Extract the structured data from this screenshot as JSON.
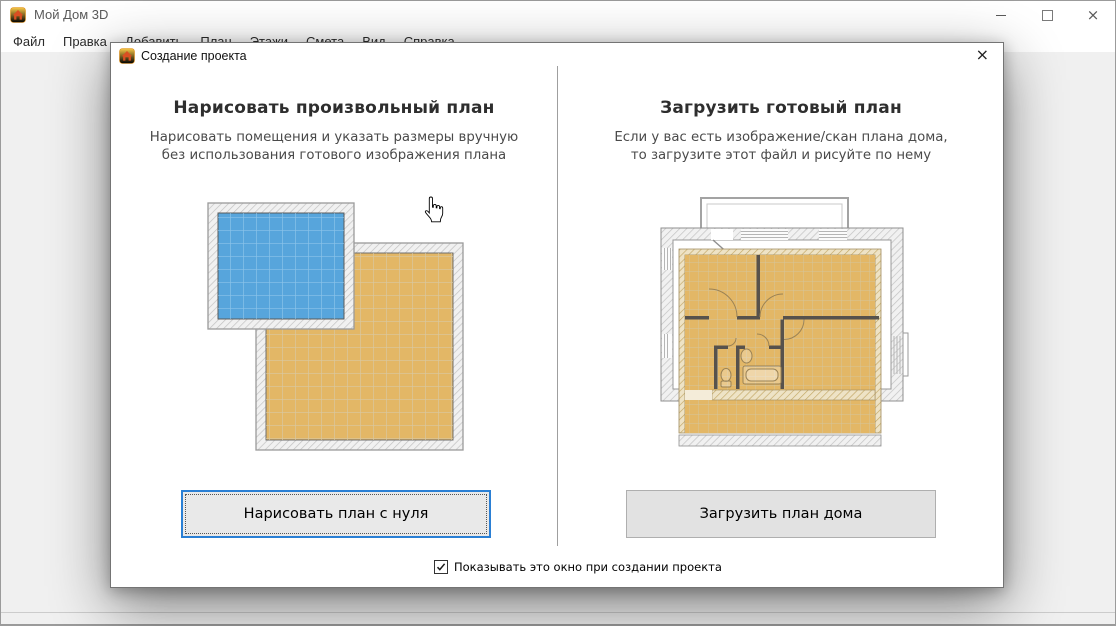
{
  "window": {
    "title": "Мой Дом 3D",
    "controls": {
      "minimize": "minimize",
      "maximize": "maximize",
      "close": "×"
    }
  },
  "menu": {
    "items": [
      "Файл",
      "Правка",
      "Добавить",
      "План",
      "Этажи",
      "Смета",
      "Вид",
      "Справка"
    ]
  },
  "dialog": {
    "title": "Создание проекта",
    "close": "×",
    "left_panel": {
      "heading": "Нарисовать произвольный план",
      "description_line1": "Нарисовать помещения и указать размеры вручную",
      "description_line2": "без использования готового изображения плана",
      "button_label": "Нарисовать план с нуля"
    },
    "right_panel": {
      "heading": "Загрузить готовый план",
      "description_line1": "Если у вас есть изображение/скан плана дома,",
      "description_line2": "то загрузите этот файл и рисуйте по нему",
      "button_label": "Загрузить план дома"
    },
    "footer_checkbox": {
      "label": "Показывать это окно при создании проекта",
      "checked": true
    }
  },
  "icons": {
    "app_icon": "house-icon",
    "dialog_icon": "house-icon",
    "cursor": "hand-cursor-icon",
    "checkbox_mark": "check-icon"
  },
  "colors": {
    "focus_accent": "#2a7fd4",
    "room_blue": "#57A5DC",
    "room_tan": "#E3B766"
  }
}
